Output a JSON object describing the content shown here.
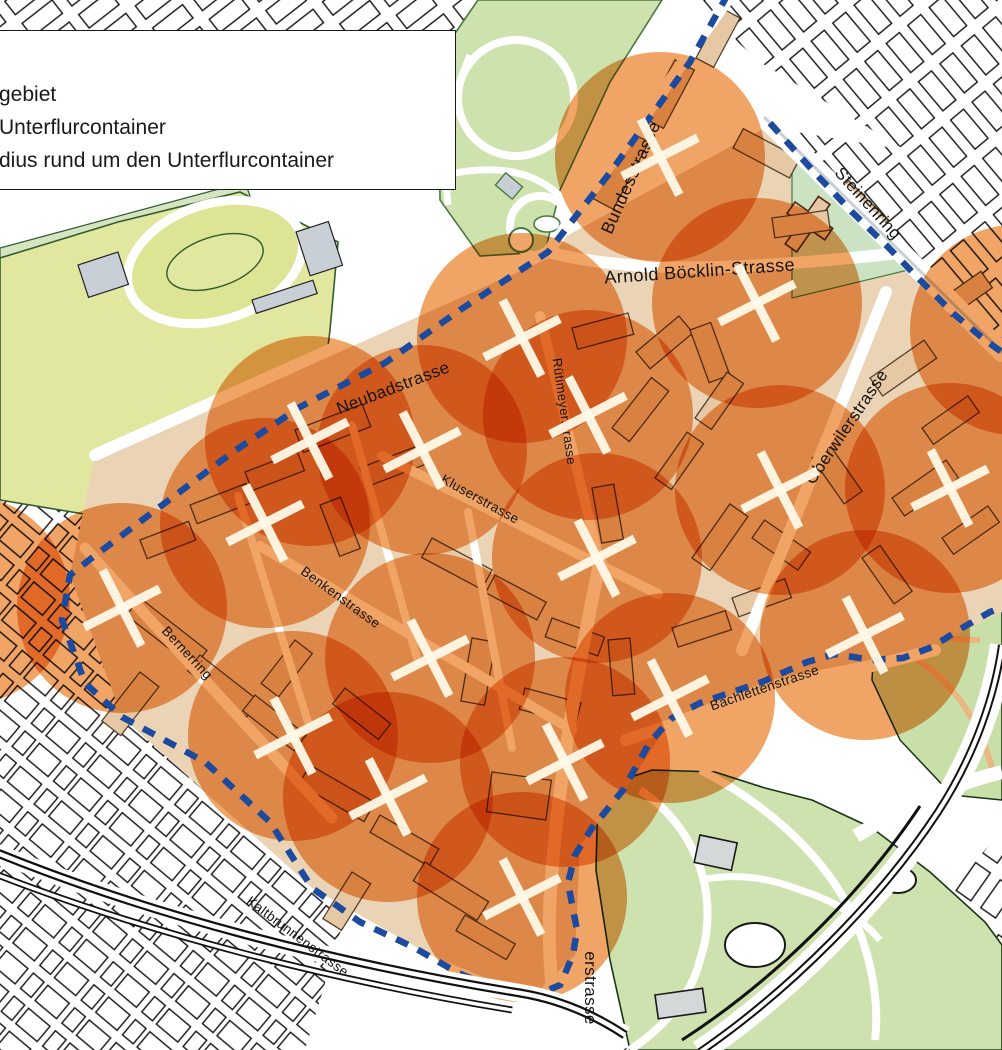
{
  "legend": {
    "lines": [
      "gebiet",
      "Unterflurcontainer",
      "dius rund um den Unterflurcontainer"
    ]
  },
  "map": {
    "street_labels": [
      {
        "name": "Bundesstrasse",
        "x": 636,
        "y": 180,
        "rotate": -66,
        "size": 17.5
      },
      {
        "name": "Arnold Böcklin-Strasse",
        "x": 700,
        "y": 277,
        "rotate": -4,
        "size": 18
      },
      {
        "name": "Steinenring",
        "x": 864,
        "y": 207,
        "rotate": 48,
        "size": 17
      },
      {
        "name": "Neubadstrasse",
        "x": 395,
        "y": 393,
        "rotate": -21,
        "size": 17
      },
      {
        "name": "Rütimeyerstrasse",
        "x": 560,
        "y": 412,
        "rotate": 82,
        "size": 13
      },
      {
        "name": "Kluserstrasse",
        "x": 478,
        "y": 503,
        "rotate": 29,
        "size": 13.5
      },
      {
        "name": "Oberwilerstrasse",
        "x": 851,
        "y": 430,
        "rotate": -56,
        "size": 17
      },
      {
        "name": "Benkenstrasse",
        "x": 338,
        "y": 601,
        "rotate": 36,
        "size": 13.5
      },
      {
        "name": "Bernerring",
        "x": 184,
        "y": 656,
        "rotate": 47,
        "size": 13.5
      },
      {
        "name": "Bachlettenstrasse",
        "x": 766,
        "y": 692,
        "rotate": -19,
        "size": 13.5
      },
      {
        "name": "Kaltbrunnenstrasse",
        "x": 295,
        "y": 940,
        "rotate": 37,
        "size": 13.5
      },
      {
        "name": "erstrasse",
        "x": 585,
        "y": 988,
        "rotate": 90,
        "size": 17
      }
    ],
    "container_markers": [
      {
        "x": 660,
        "y": 157
      },
      {
        "x": 757,
        "y": 303
      },
      {
        "x": 522,
        "y": 338
      },
      {
        "x": 588,
        "y": 415
      },
      {
        "x": 310,
        "y": 441
      },
      {
        "x": 422,
        "y": 450
      },
      {
        "x": 950,
        "y": 488
      },
      {
        "x": 780,
        "y": 490
      },
      {
        "x": 265,
        "y": 523
      },
      {
        "x": 597,
        "y": 558
      },
      {
        "x": 122,
        "y": 608
      },
      {
        "x": 865,
        "y": 635
      },
      {
        "x": 430,
        "y": 658
      },
      {
        "x": 670,
        "y": 698
      },
      {
        "x": 293,
        "y": 736
      },
      {
        "x": 565,
        "y": 762
      },
      {
        "x": 388,
        "y": 797
      },
      {
        "x": 522,
        "y": 897
      }
    ],
    "radius_circles": {
      "radius": 105,
      "extra_centers": [
        {
          "x": -35,
          "y": 600
        },
        {
          "x": 1015,
          "y": 330
        }
      ]
    },
    "colors": {
      "circle_fill": "#F0A465",
      "boundary_blue": "#1C4A9E",
      "marker_white": "#FFF9E8",
      "park_green": "#CDE2AC",
      "field_yellow": "#E2E79F",
      "zoo_green": "#CDE2AE",
      "building_tan": "#E6C8A4",
      "outline_black": "#1A1A1A"
    }
  }
}
